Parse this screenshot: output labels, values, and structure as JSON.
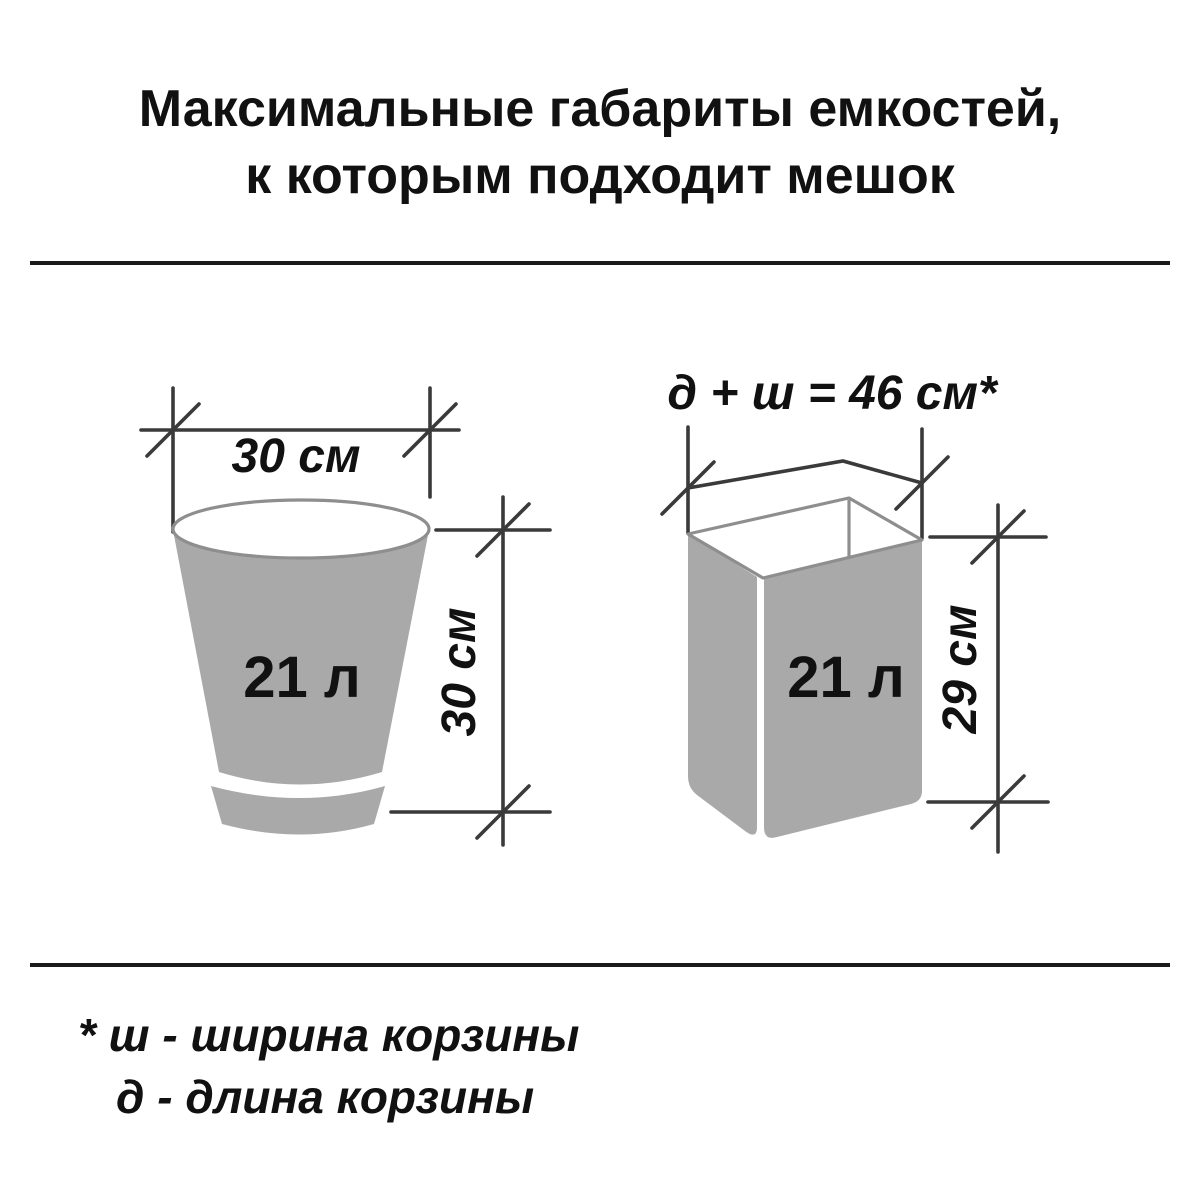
{
  "title": {
    "line1": "Максимальные габариты емкостей,",
    "line2": "к которым подходит мешок"
  },
  "left_diagram": {
    "name": "round-bin",
    "width_label": "30 см",
    "height_label": "30 см",
    "volume_label": "21 л"
  },
  "right_diagram": {
    "name": "rectangular-bin",
    "formula_label": "д + ш = 46 см*",
    "height_label": "29 см",
    "volume_label": "21 л"
  },
  "footnote": {
    "line1": "* ш - ширина корзины",
    "line2": "д  - длина корзины"
  },
  "colors": {
    "bg": "#ffffff",
    "text": "#111111",
    "dim_line": "#3a3a3a",
    "bin_fill": "#a9a9a9",
    "rim_stroke": "#8e8e8e",
    "rule": "#1a1a1a"
  }
}
